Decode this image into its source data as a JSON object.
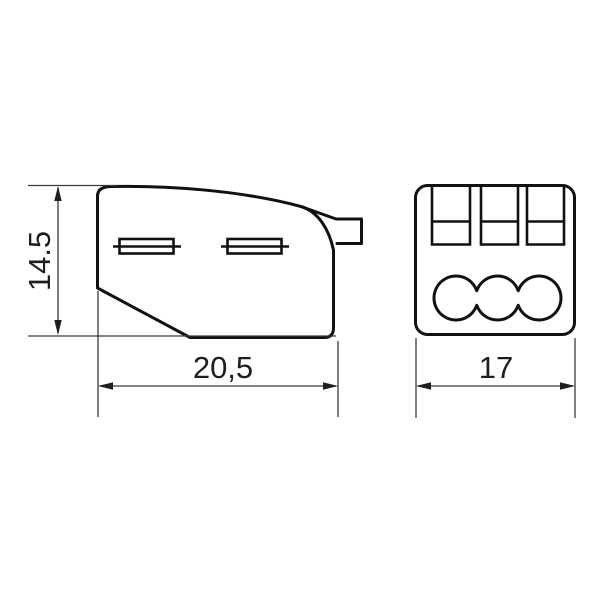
{
  "drawing": {
    "type": "technical-dimension-drawing",
    "subject": "3-pole push-wire connector",
    "dimensions": {
      "height_mm": "14.5",
      "length_mm": "20,5",
      "width_mm": "17"
    },
    "front_view": {
      "clamp_slot_count": 3,
      "wire_hole_count": 3
    },
    "side_view": {
      "funnel_slot_count": 2,
      "test_tab_count": 1
    },
    "colors": {
      "background": "#ffffff",
      "outline": "#111111",
      "dimension_line": "#3a3a3a",
      "label_text": "#1e1e1e"
    }
  }
}
